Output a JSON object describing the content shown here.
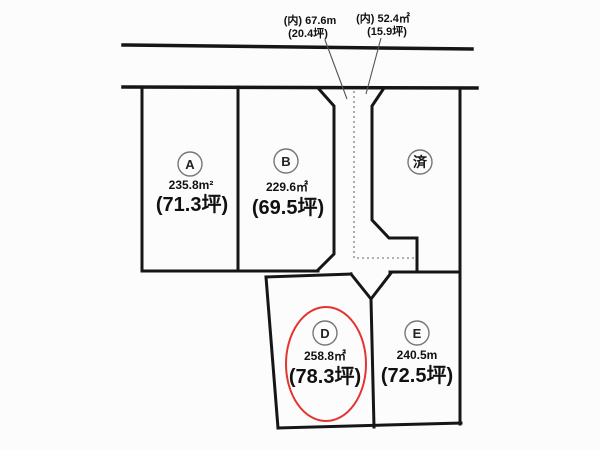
{
  "diagram_type": "land-plot-layout",
  "colors": {
    "background": "#fcfcfc",
    "boundary_line": "#161616",
    "leader_line": "#555555",
    "dotted_line": "#999999",
    "label_circle": "#777777",
    "highlight_ellipse": "#e53430"
  },
  "annotations": {
    "inner_left": {
      "line1": "(内) 67.6m",
      "line2": "(20.4坪)"
    },
    "inner_right": {
      "line1": "(内) 52.4㎡",
      "line2": "(15.9坪)"
    }
  },
  "plots": {
    "a": {
      "label": "A",
      "area_m2": "235.8m²",
      "area_tsubo": "(71.3坪)"
    },
    "b": {
      "label": "B",
      "area_m2": "229.6㎡",
      "area_tsubo": "(69.5坪)"
    },
    "sold": {
      "label": "済"
    },
    "d": {
      "label": "D",
      "area_m2": "258.8㎡",
      "area_tsubo": "(78.3坪)",
      "highlighted": true
    },
    "e": {
      "label": "E",
      "area_m2": "240.5m",
      "area_tsubo": "(72.5坪)"
    }
  }
}
